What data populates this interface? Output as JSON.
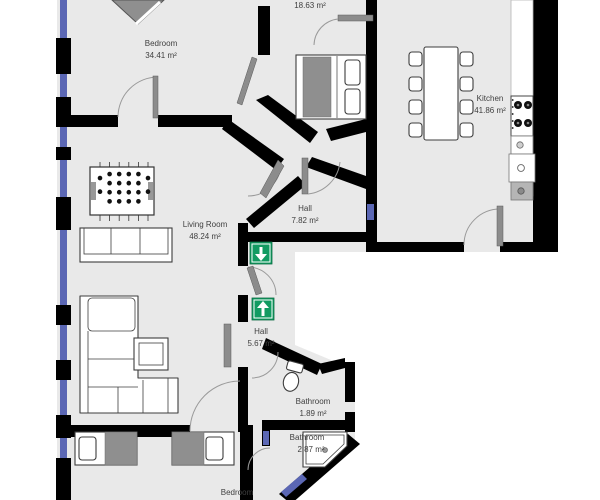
{
  "plan": {
    "rooms": [
      {
        "name": "Bedroom",
        "area": "34.41 m²"
      },
      {
        "name": "",
        "area": "18.63 m²"
      },
      {
        "name": "Kitchen",
        "area": "41.86 m²"
      },
      {
        "name": "Hall",
        "area": "7.82 m²"
      },
      {
        "name": "Living Room",
        "area": "48.24 m²"
      },
      {
        "name": "Hall",
        "area": "5.67 m²"
      },
      {
        "name": "Bathroom",
        "area": "1.89 m²"
      },
      {
        "name": "Bathroom",
        "area": "2.87 m²"
      },
      {
        "name": "Bedroom",
        "area": ""
      }
    ],
    "signs": [
      {
        "name": "entrance-direction-down",
        "direction": "down",
        "color": "#129b62"
      },
      {
        "name": "entrance-direction-up",
        "direction": "up",
        "color": "#129b62"
      }
    ],
    "colors": {
      "wall": "#000000",
      "floor": "#e9e9e9",
      "window": "#5b67b4",
      "exit_green": "#129b62",
      "furniture_gray": "#8f8f8f"
    },
    "furniture": [
      "grand-piano",
      "double-bed",
      "dining-table",
      "dining-chairs-8",
      "kitchen-counter",
      "stove",
      "kitchen-sink",
      "dishwasher",
      "washing-machine",
      "foosball-table",
      "sideboard",
      "corner-sofa",
      "coffee-table",
      "door-leaf",
      "single-bed-left",
      "single-bed-right",
      "toilet",
      "corner-shower"
    ]
  }
}
